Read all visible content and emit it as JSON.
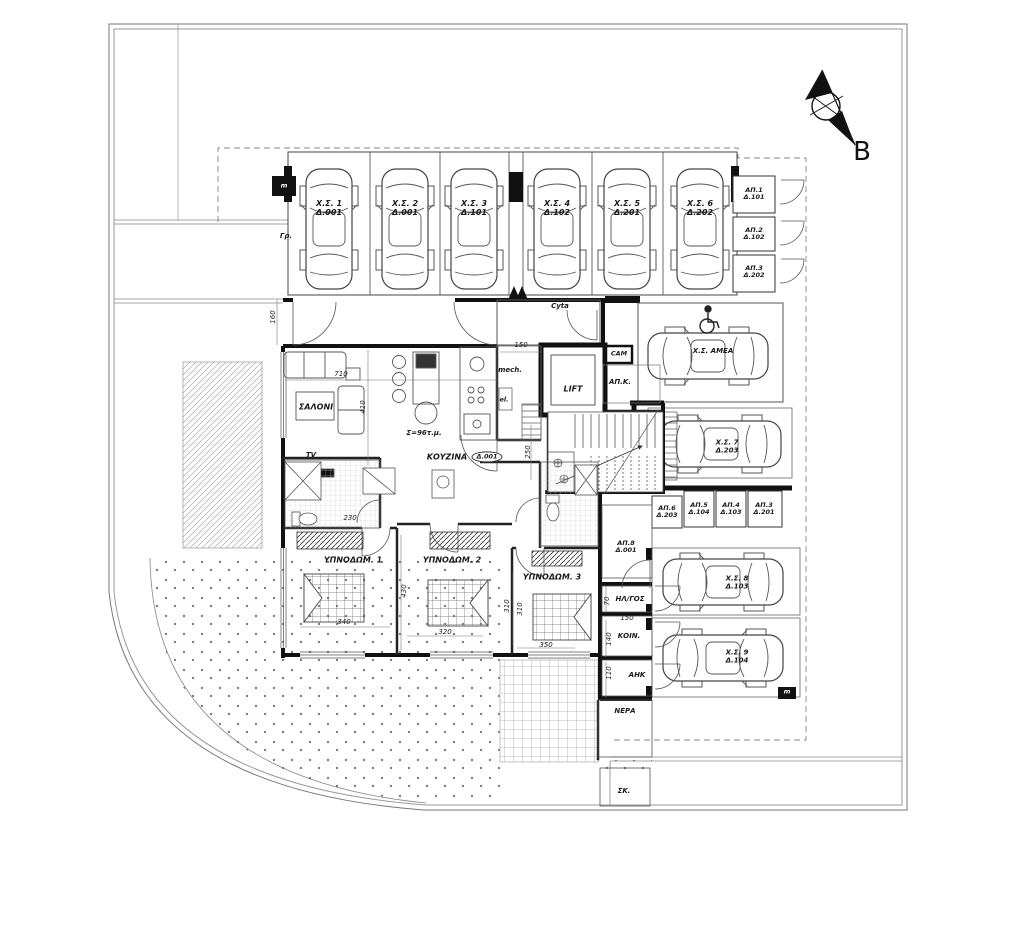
{
  "compass": {
    "north_label": "B"
  },
  "site": {
    "mailboxes_label": "Γρ.",
    "meter_label_top": "m",
    "meter_label_bottom": "m"
  },
  "parking": {
    "stalls": [
      {
        "name": "Χ.Σ. 1",
        "unit": "Δ.001"
      },
      {
        "name": "Χ.Σ. 2",
        "unit": "Δ.001"
      },
      {
        "name": "Χ.Σ. 3",
        "unit": "Δ.101"
      },
      {
        "name": "Χ.Σ. 4",
        "unit": "Δ.102"
      },
      {
        "name": "Χ.Σ. 5",
        "unit": "Δ.201"
      },
      {
        "name": "Χ.Σ. 6",
        "unit": "Δ.202"
      }
    ],
    "amea": {
      "name": "Χ.Σ. ΑΜΕΑ"
    },
    "s7": {
      "name": "Χ.Σ. 7",
      "unit": "Δ.203"
    },
    "s8": {
      "name": "Χ.Σ. 8",
      "unit": "Δ.103"
    },
    "s9": {
      "name": "Χ.Σ. 9",
      "unit": "Δ.104"
    }
  },
  "storage": {
    "right": [
      {
        "name": "ΑΠ.1",
        "unit": "Δ.101"
      },
      {
        "name": "ΑΠ.2",
        "unit": "Δ.102"
      },
      {
        "name": "ΑΠ.3",
        "unit": "Δ.202"
      }
    ],
    "row": [
      {
        "name": "ΑΠ.6",
        "unit": "Δ.203"
      },
      {
        "name": "ΑΠ.5",
        "unit": "Δ.104"
      },
      {
        "name": "ΑΠ.4",
        "unit": "Δ.103"
      },
      {
        "name": "ΑΠ.3",
        "unit": "Δ.201"
      }
    ],
    "apartment": {
      "name": "ΑΠ.8",
      "unit": "Δ.001"
    }
  },
  "rooms": {
    "living": "ΣΑΛΟΝΙ",
    "tv": "TV",
    "kitchen": "ΚΟΥΖΙΝΑ",
    "unit_tag": "Δ.001",
    "area_note": "Σ=96τ.μ.",
    "bed1": "ΥΠΝΟΔΩΜ. 1",
    "bed2": "ΥΠΝΟΔΩΜ. 2",
    "bed3": "ΥΠΝΟΔΩΜ. 3",
    "lift": "LIFT",
    "mech": "mech.",
    "el": "el.",
    "cyta": "Cyta",
    "cam": "CAM",
    "apk": "ΑΠ.Κ.",
    "electrical": "ΗΛ/ΓΟΣ",
    "common": "ΚΟΙΝ.",
    "ahk": "ΑΗΚ",
    "water": "ΝΕΡΑ",
    "sk": "ΣΚ."
  },
  "dims": {
    "d160": "160",
    "d710": "710",
    "d410": "410",
    "d150_entry": "150",
    "d250": "250",
    "d230": "230",
    "d340": "340",
    "d430": "430",
    "d320": "320",
    "d310_a": "310",
    "d310_b": "310",
    "d350": "350",
    "d70": "70",
    "d150_door": "150",
    "d140": "140",
    "d110": "110"
  }
}
